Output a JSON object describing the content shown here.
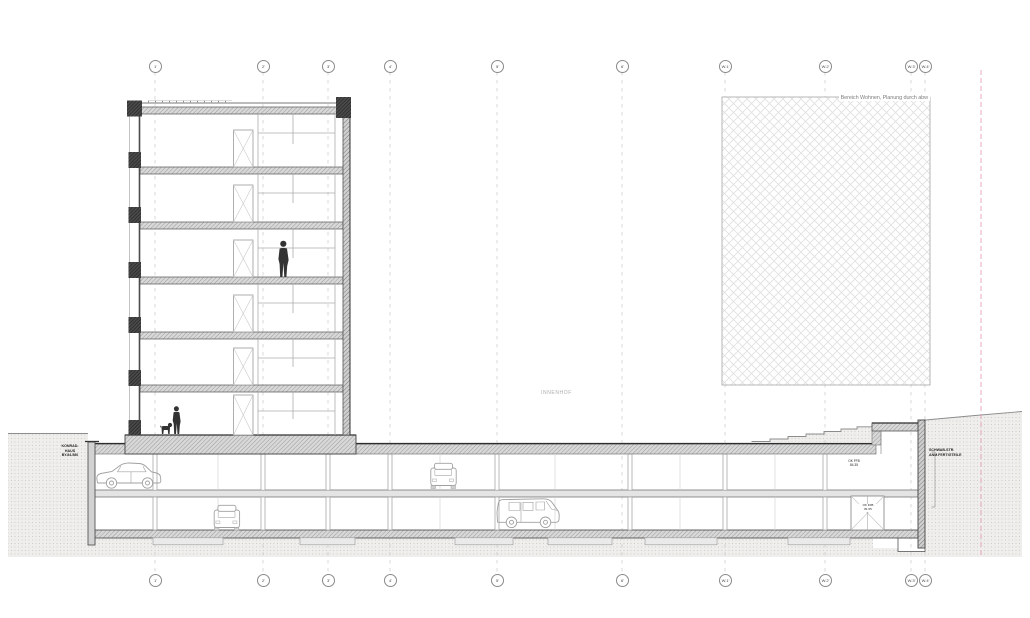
{
  "annotations": {
    "area_note": "Bereich Wohnen, Planung durch abw",
    "courtyard": "INNENHOF",
    "left_building": [
      "KONRAD-",
      "HAUS",
      "BY.84.580"
    ],
    "right_street": [
      "SCHWAB-STR.",
      "ANM.FERTIGTEILE"
    ],
    "ug1_level": [
      "OK FFB",
      "84.35"
    ],
    "ug2_door": [
      "OK FFB",
      "81.55"
    ]
  },
  "grid": {
    "markers": [
      {
        "label": "1'",
        "x": 155
      },
      {
        "label": "2'",
        "x": 263
      },
      {
        "label": "3'",
        "x": 328
      },
      {
        "label": "4'",
        "x": 390
      },
      {
        "label": "5'",
        "x": 497
      },
      {
        "label": "6'",
        "x": 622
      },
      {
        "label": "W.1'",
        "x": 725
      },
      {
        "label": "W.2'",
        "x": 825
      },
      {
        "label": "W.3'",
        "x": 911
      },
      {
        "label": "W.4'",
        "x": 925
      }
    ]
  },
  "scene": {
    "building_floors": 7,
    "garage_levels": 2,
    "cars": [
      "sedan-side-view",
      "car-front-view",
      "car-front-view",
      "van-side-view"
    ],
    "figures": [
      "person-standing",
      "person-with-dog"
    ]
  },
  "colors": {
    "boundary_pink": "#dd8fae",
    "earth_fill": "#efeeec",
    "earth_dot": "#c7c5c2",
    "slab_gray": "#d8d8d8",
    "wall_dark": "#3a3a3a",
    "crosshatch_line": "#e0e0e0",
    "grid_line": "#c8c8c8"
  }
}
